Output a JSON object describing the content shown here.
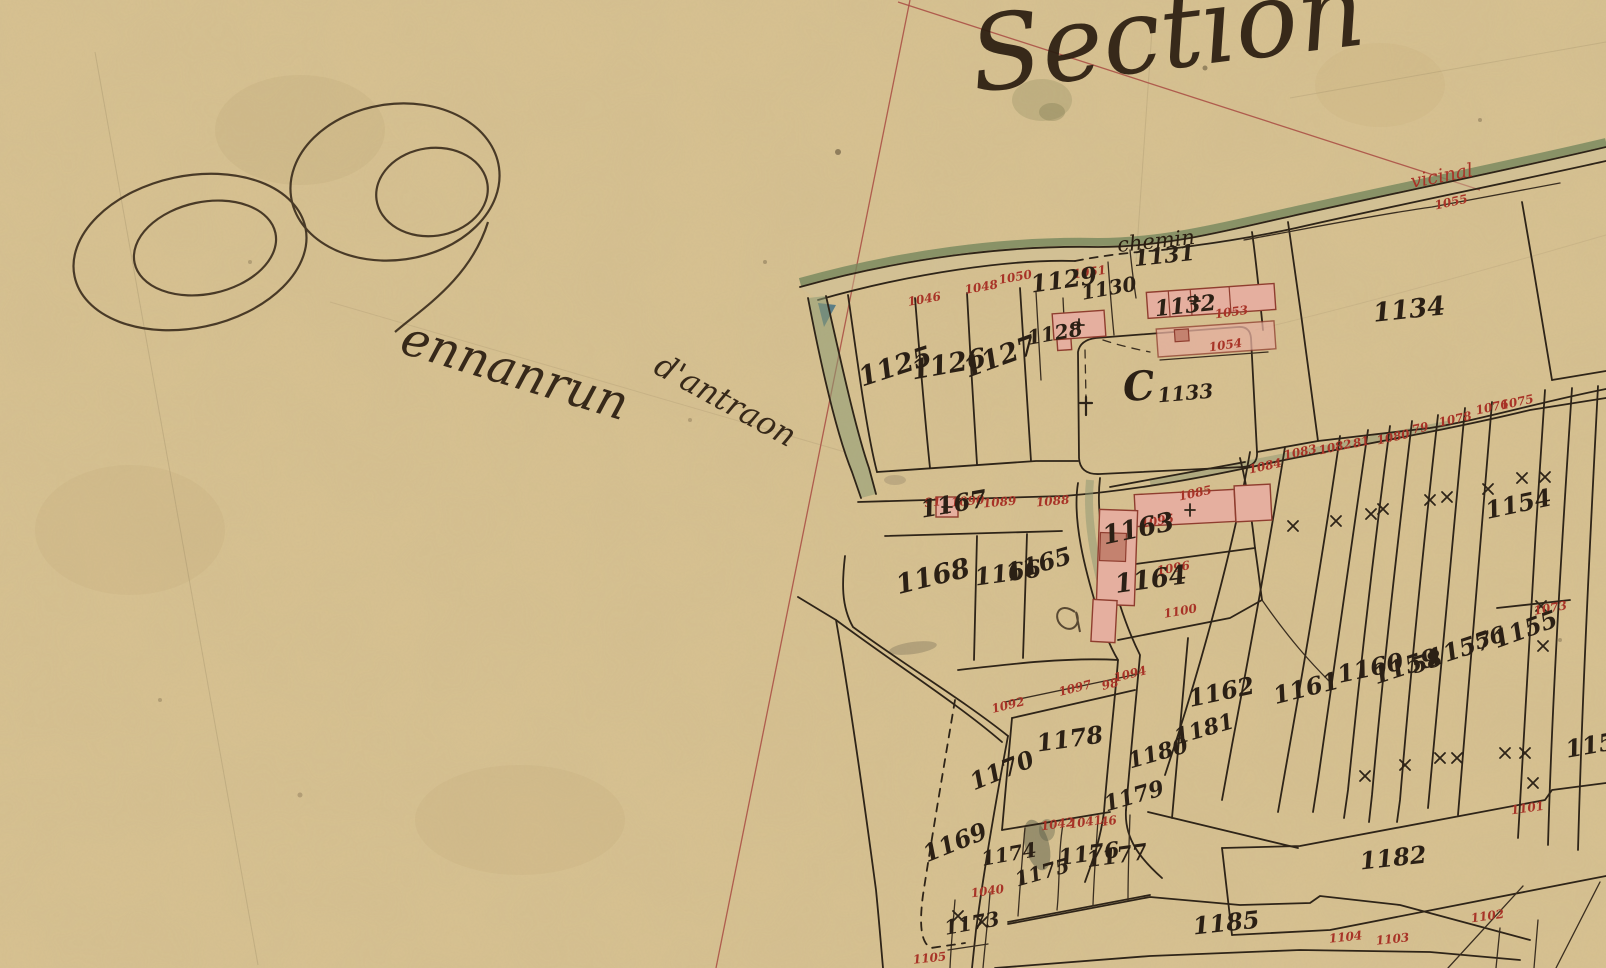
{
  "map": {
    "title": "Section",
    "place": {
      "full": "Pennanrun d'antraon",
      "initial": "P",
      "rest1": "ennanrun",
      "rest2": "d'antraon"
    },
    "road_labels": {
      "chemin": "chemin",
      "vicinal": "vicinal"
    },
    "colors": {
      "parchment": "#d8c291",
      "ink": "#2b2015",
      "red_ink": "#a83327",
      "section_line_red": "#a84a42",
      "building_pink": "#e5af9f",
      "building_dark": "#c4826f",
      "road_green": "#75875c",
      "water_blue": "#4e7585"
    },
    "parcel_labels": [
      {
        "text": "1125",
        "x": 898,
        "y": 375,
        "rot": -18,
        "fs": 27
      },
      {
        "text": "1126",
        "x": 950,
        "y": 373,
        "rot": -10,
        "fs": 27
      },
      {
        "text": "1127",
        "x": 1003,
        "y": 365,
        "rot": -20,
        "fs": 27
      },
      {
        "text": "1128",
        "x": 1056,
        "y": 340,
        "rot": -10,
        "fs": 20
      },
      {
        "text": "1129",
        "x": 1065,
        "y": 288,
        "rot": -8,
        "fs": 24
      },
      {
        "text": "1130",
        "x": 1110,
        "y": 295,
        "rot": -10,
        "fs": 20
      },
      {
        "text": "1131",
        "x": 1165,
        "y": 263,
        "rot": -6,
        "fs": 22
      },
      {
        "text": "1132",
        "x": 1186,
        "y": 313,
        "rot": -6,
        "fs": 22
      },
      {
        "text": "C",
        "x": 1140,
        "y": 400,
        "rot": -5,
        "fs": 40
      },
      {
        "text": "1133",
        "x": 1186,
        "y": 400,
        "rot": -5,
        "fs": 20
      },
      {
        "text": "1134",
        "x": 1410,
        "y": 318,
        "rot": -6,
        "fs": 26
      },
      {
        "text": "1154",
        "x": 1520,
        "y": 512,
        "rot": -12,
        "fs": 24
      },
      {
        "text": "1155",
        "x": 1528,
        "y": 637,
        "rot": -20,
        "fs": 24
      },
      {
        "text": "56",
        "x": 1492,
        "y": 645,
        "rot": -18,
        "fs": 22
      },
      {
        "text": "1157",
        "x": 1462,
        "y": 657,
        "rot": -18,
        "fs": 24
      },
      {
        "text": "58",
        "x": 1429,
        "y": 669,
        "rot": -18,
        "fs": 22
      },
      {
        "text": "1159",
        "x": 1408,
        "y": 674,
        "rot": -18,
        "fs": 24
      },
      {
        "text": "1160",
        "x": 1372,
        "y": 676,
        "rot": -12,
        "fs": 24
      },
      {
        "text": "1161",
        "x": 1308,
        "y": 696,
        "rot": -14,
        "fs": 24
      },
      {
        "text": "1162",
        "x": 1223,
        "y": 700,
        "rot": -12,
        "fs": 24
      },
      {
        "text": "1163",
        "x": 1140,
        "y": 537,
        "rot": -12,
        "fs": 26
      },
      {
        "text": "1164",
        "x": 1152,
        "y": 588,
        "rot": -8,
        "fs": 26
      },
      {
        "text": "1165",
        "x": 1041,
        "y": 572,
        "rot": -16,
        "fs": 24
      },
      {
        "text": "1166",
        "x": 1009,
        "y": 581,
        "rot": -8,
        "fs": 24
      },
      {
        "text": "1167",
        "x": 955,
        "y": 512,
        "rot": -10,
        "fs": 24
      },
      {
        "text": "1168",
        "x": 935,
        "y": 585,
        "rot": -14,
        "fs": 27
      },
      {
        "text": "1169",
        "x": 958,
        "y": 850,
        "rot": -22,
        "fs": 24
      },
      {
        "text": "1170",
        "x": 1005,
        "y": 778,
        "rot": -22,
        "fs": 24
      },
      {
        "text": "1173",
        "x": 973,
        "y": 930,
        "rot": -10,
        "fs": 20
      },
      {
        "text": "1174",
        "x": 1010,
        "y": 861,
        "rot": -10,
        "fs": 20
      },
      {
        "text": "1175",
        "x": 1044,
        "y": 879,
        "rot": -16,
        "fs": 20
      },
      {
        "text": "1176",
        "x": 1090,
        "y": 861,
        "rot": -8,
        "fs": 22
      },
      {
        "text": "1177",
        "x": 1118,
        "y": 863,
        "rot": -8,
        "fs": 22
      },
      {
        "text": "1178",
        "x": 1071,
        "y": 747,
        "rot": -8,
        "fs": 24
      },
      {
        "text": "1179",
        "x": 1136,
        "y": 803,
        "rot": -16,
        "fs": 22
      },
      {
        "text": "1180",
        "x": 1160,
        "y": 760,
        "rot": -16,
        "fs": 22
      },
      {
        "text": "1181",
        "x": 1206,
        "y": 736,
        "rot": -16,
        "fs": 22
      },
      {
        "text": "1182",
        "x": 1394,
        "y": 866,
        "rot": -6,
        "fs": 24
      },
      {
        "text": "1185",
        "x": 1227,
        "y": 931,
        "rot": -6,
        "fs": 24
      },
      {
        "text": "1152",
        "x": 1600,
        "y": 752,
        "rot": -10,
        "fs": 24
      }
    ],
    "red_labels": [
      {
        "text": "1046",
        "x": 925,
        "y": 303,
        "rot": -10
      },
      {
        "text": "1048",
        "x": 982,
        "y": 291,
        "rot": -10
      },
      {
        "text": "1050",
        "x": 1016,
        "y": 281,
        "rot": -10
      },
      {
        "text": "1051",
        "x": 1090,
        "y": 276,
        "rot": -8
      },
      {
        "text": "1053",
        "x": 1232,
        "y": 316,
        "rot": -8
      },
      {
        "text": "1054",
        "x": 1226,
        "y": 349,
        "rot": -8
      },
      {
        "text": "1055",
        "x": 1452,
        "y": 206,
        "rot": -12
      },
      {
        "text": "1080",
        "x": 1394,
        "y": 441,
        "rot": -12
      },
      {
        "text": "79",
        "x": 1421,
        "y": 432,
        "rot": -12
      },
      {
        "text": "1078",
        "x": 1456,
        "y": 423,
        "rot": -12
      },
      {
        "text": "1076",
        "x": 1493,
        "y": 411,
        "rot": -12
      },
      {
        "text": "1075",
        "x": 1518,
        "y": 406,
        "rot": -12
      },
      {
        "text": "1083",
        "x": 1301,
        "y": 456,
        "rot": -12
      },
      {
        "text": "1082",
        "x": 1336,
        "y": 451,
        "rot": -12
      },
      {
        "text": "81",
        "x": 1362,
        "y": 446,
        "rot": -12
      },
      {
        "text": "1084",
        "x": 1266,
        "y": 470,
        "rot": -12
      },
      {
        "text": "1085",
        "x": 1196,
        "y": 497,
        "rot": -12
      },
      {
        "text": "1088",
        "x": 1053,
        "y": 505,
        "rot": -5
      },
      {
        "text": "1089",
        "x": 1000,
        "y": 506,
        "rot": -5
      },
      {
        "text": "1090",
        "x": 968,
        "y": 505,
        "rot": -5
      },
      {
        "text": "91",
        "x": 933,
        "y": 506,
        "rot": -5
      },
      {
        "text": "1095",
        "x": 1158,
        "y": 525,
        "rot": -10
      },
      {
        "text": "1096",
        "x": 1174,
        "y": 572,
        "rot": -10
      },
      {
        "text": "1100",
        "x": 1181,
        "y": 615,
        "rot": -10
      },
      {
        "text": "1073",
        "x": 1551,
        "y": 612,
        "rot": -10
      },
      {
        "text": "1092",
        "x": 1009,
        "y": 709,
        "rot": -14
      },
      {
        "text": "1097",
        "x": 1076,
        "y": 692,
        "rot": -14
      },
      {
        "text": "98",
        "x": 1111,
        "y": 688,
        "rot": -14
      },
      {
        "text": "1094",
        "x": 1131,
        "y": 678,
        "rot": -14
      },
      {
        "text": "1042",
        "x": 1058,
        "y": 828,
        "rot": -8
      },
      {
        "text": "1041",
        "x": 1086,
        "y": 826,
        "rot": -8
      },
      {
        "text": "46",
        "x": 1109,
        "y": 825,
        "rot": -8
      },
      {
        "text": "1040",
        "x": 988,
        "y": 895,
        "rot": -8
      },
      {
        "text": "1101",
        "x": 1528,
        "y": 812,
        "rot": -8
      },
      {
        "text": "1102",
        "x": 1488,
        "y": 920,
        "rot": -8
      },
      {
        "text": "1104",
        "x": 1346,
        "y": 941,
        "rot": -6
      },
      {
        "text": "1103",
        "x": 1393,
        "y": 943,
        "rot": -6
      },
      {
        "text": "1105",
        "x": 930,
        "y": 962,
        "rot": -6
      }
    ],
    "symbols": {
      "x_marks": [
        [
          1293,
          526
        ],
        [
          1336,
          521
        ],
        [
          1371,
          514
        ],
        [
          1383,
          509
        ],
        [
          1430,
          500
        ],
        [
          1447,
          497
        ],
        [
          1488,
          489
        ],
        [
          1522,
          478
        ],
        [
          1545,
          477
        ],
        [
          1541,
          606
        ],
        [
          1543,
          646
        ],
        [
          1505,
          753
        ],
        [
          1525,
          753
        ],
        [
          1533,
          783
        ],
        [
          1365,
          776
        ],
        [
          1405,
          765
        ],
        [
          1440,
          758
        ],
        [
          1457,
          758
        ],
        [
          958,
          916
        ],
        [
          982,
          922
        ]
      ],
      "building_crosses": [
        [
          1079,
          325
        ],
        [
          1195,
          301
        ],
        [
          1190,
          510
        ],
        [
          947,
          507
        ]
      ],
      "calvary_cross": [
        1086,
        406
      ]
    }
  }
}
